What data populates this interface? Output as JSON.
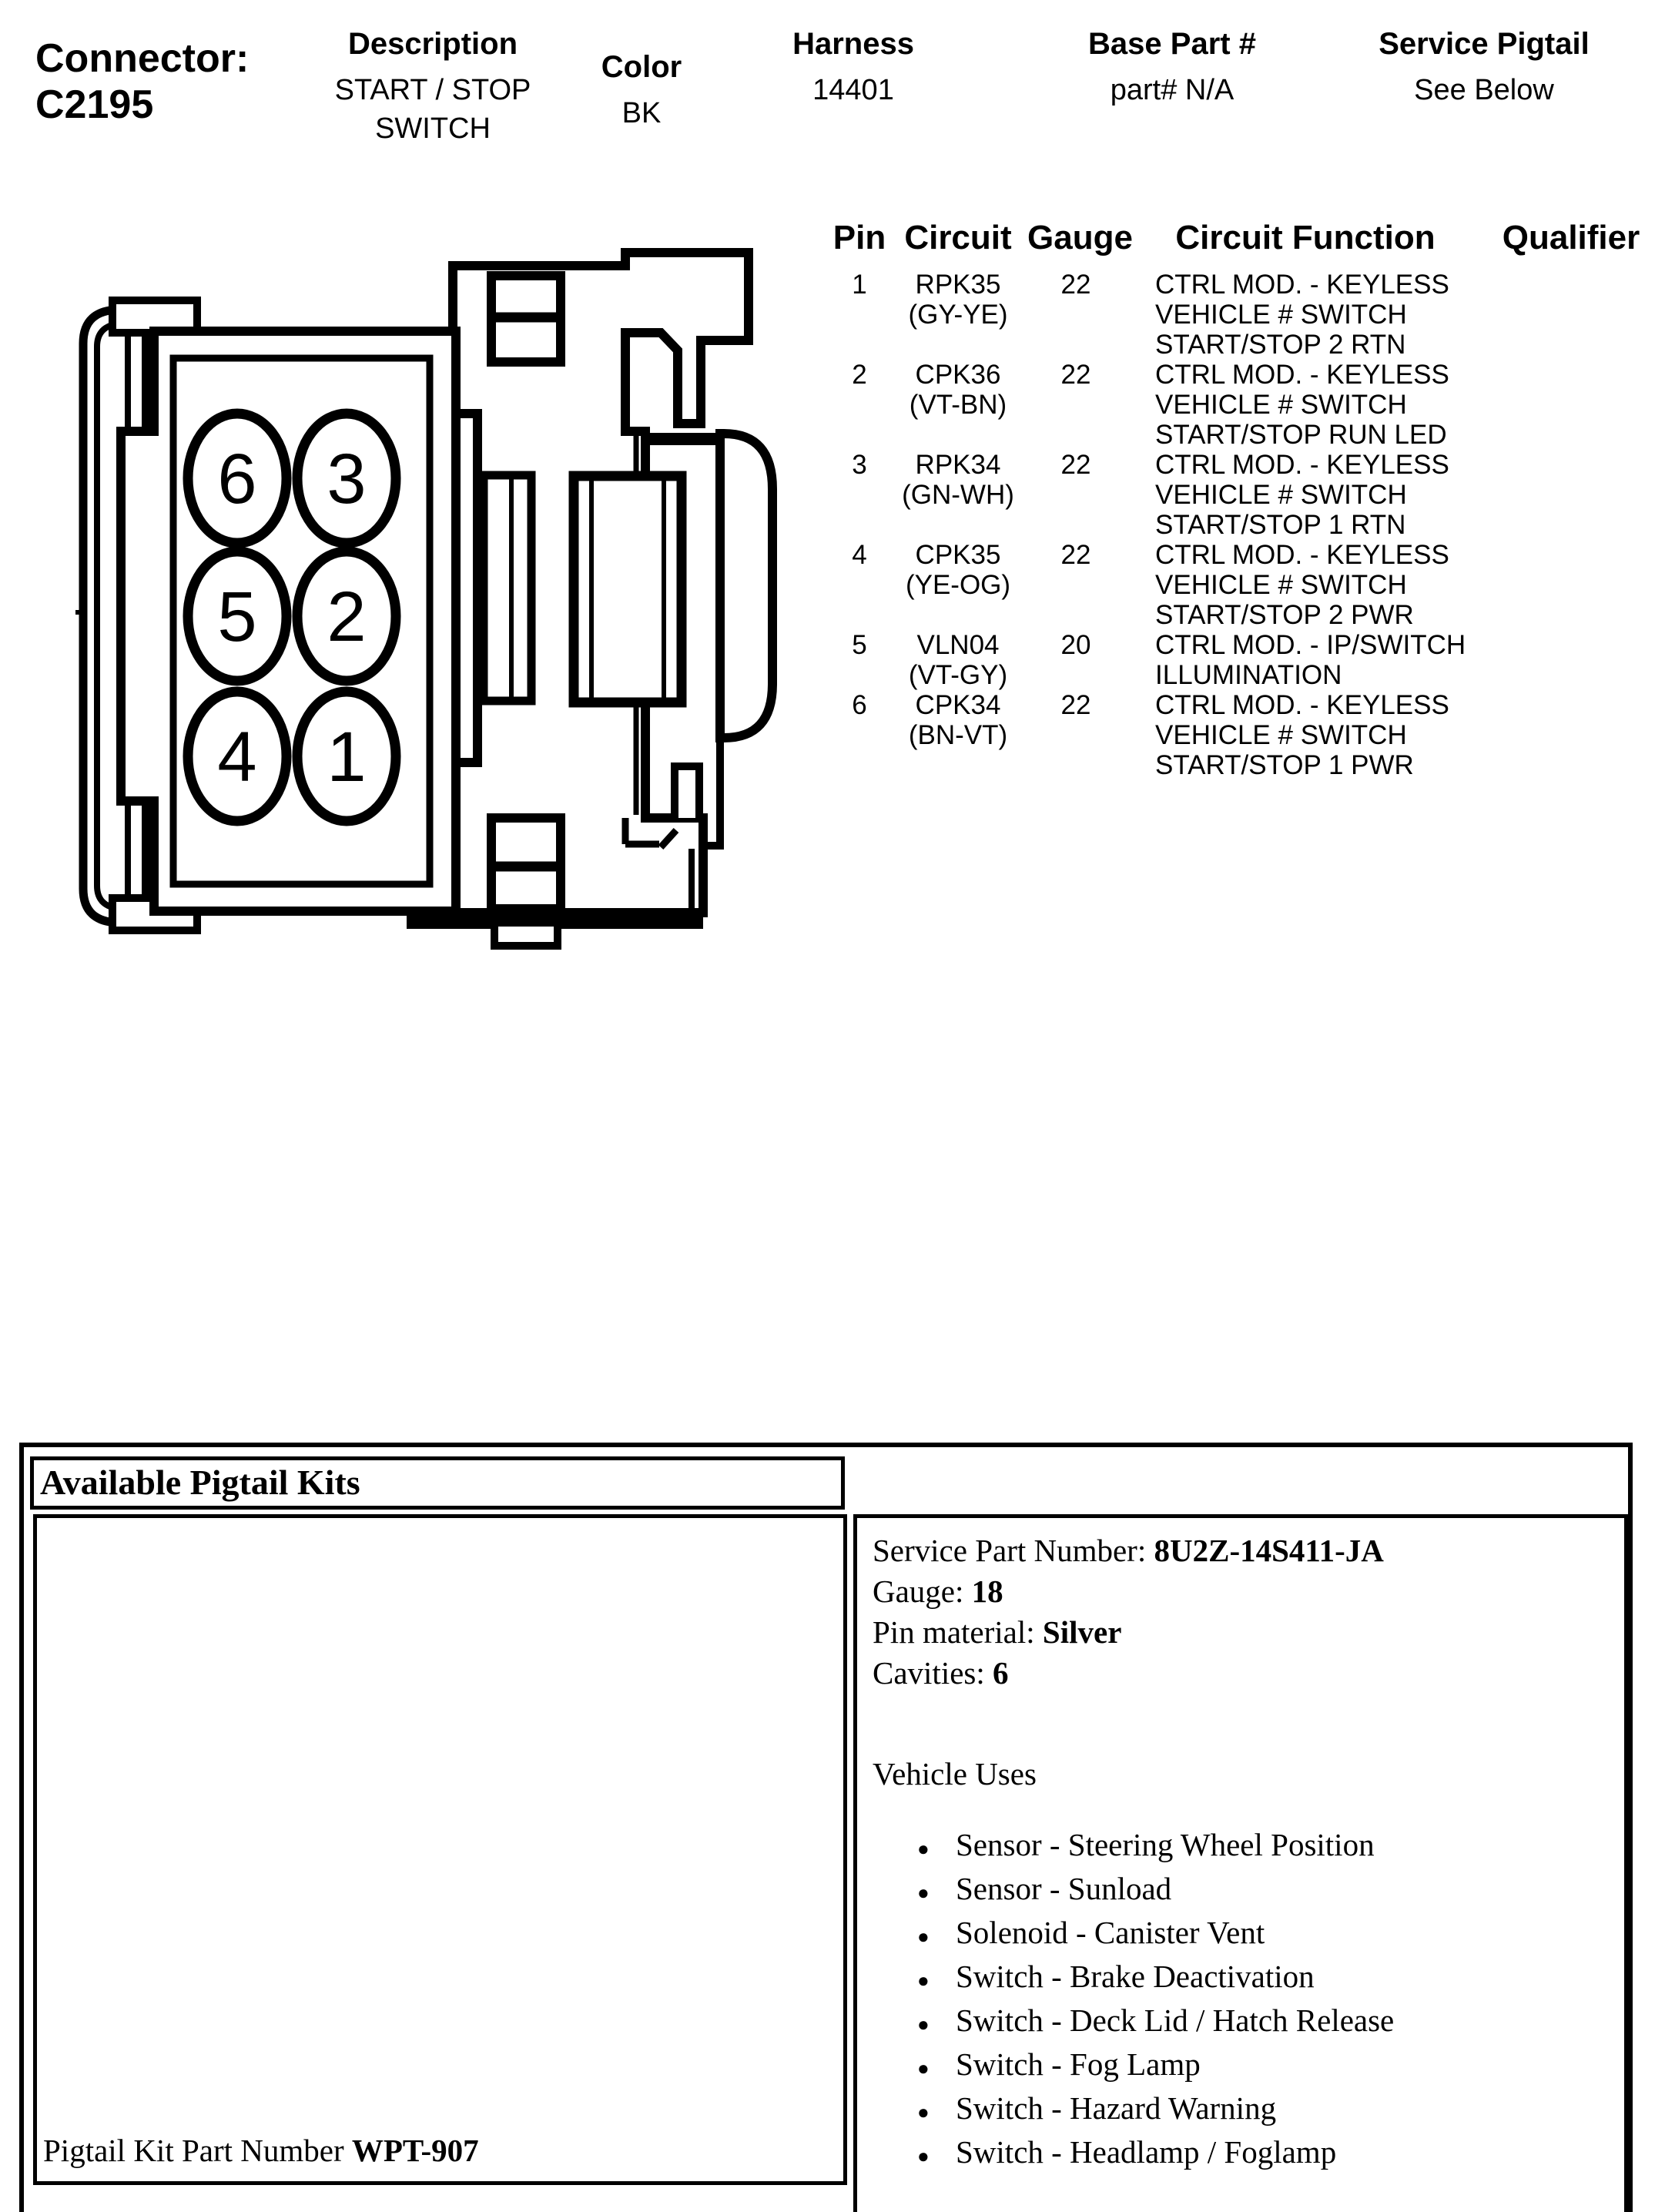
{
  "header": {
    "connector_label": "Connector:",
    "connector_id": "C2195",
    "description": {
      "label": "Description",
      "value": "START / STOP\nSWITCH"
    },
    "color": {
      "label": "Color",
      "value": "BK"
    },
    "harness": {
      "label": "Harness",
      "value": "14401"
    },
    "base_part": {
      "label": "Base Part #",
      "value": "part# N/A"
    },
    "service_pigtail": {
      "label": "Service Pigtail",
      "value": "See Below"
    }
  },
  "pin_table": {
    "headers": {
      "pin": "Pin",
      "circuit": "Circuit",
      "gauge": "Gauge",
      "function": "Circuit Function",
      "qualifier": "Qualifier"
    },
    "rows": [
      {
        "pin": "1",
        "circuit": "RPK35\n(GY-YE)",
        "gauge": "22",
        "function": "CTRL MOD. - KEYLESS\nVEHICLE # SWITCH\nSTART/STOP 2 RTN",
        "qualifier": ""
      },
      {
        "pin": "2",
        "circuit": "CPK36\n(VT-BN)",
        "gauge": "22",
        "function": "CTRL MOD. - KEYLESS\nVEHICLE # SWITCH\nSTART/STOP RUN LED",
        "qualifier": ""
      },
      {
        "pin": "3",
        "circuit": "RPK34\n(GN-WH)",
        "gauge": "22",
        "function": "CTRL MOD. - KEYLESS\nVEHICLE # SWITCH\nSTART/STOP 1 RTN",
        "qualifier": ""
      },
      {
        "pin": "4",
        "circuit": "CPK35\n(YE-OG)",
        "gauge": "22",
        "function": "CTRL MOD. - KEYLESS\nVEHICLE # SWITCH\nSTART/STOP 2 PWR",
        "qualifier": ""
      },
      {
        "pin": "5",
        "circuit": "VLN04\n(VT-GY)",
        "gauge": "20",
        "function": "CTRL MOD. - IP/SWITCH\nILLUMINATION",
        "qualifier": ""
      },
      {
        "pin": "6",
        "circuit": "CPK34\n(BN-VT)",
        "gauge": "22",
        "function": "CTRL MOD. - KEYLESS\nVEHICLE # SWITCH\nSTART/STOP 1 PWR",
        "qualifier": ""
      }
    ]
  },
  "diagram": {
    "pins": [
      "6",
      "3",
      "5",
      "2",
      "4",
      "1"
    ]
  },
  "pigtail": {
    "title": "Available Pigtail Kits",
    "kit_label": "Pigtail Kit Part Number ",
    "kit_number": "WPT-907",
    "service_part_label": "Service Part Number: ",
    "service_part_number": "8U2Z-14S411-JA",
    "gauge_label": "Gauge: ",
    "gauge_value": "18",
    "pin_material_label": "Pin material: ",
    "pin_material_value": "Silver",
    "cavities_label": "Cavities: ",
    "cavities_value": "6",
    "vehicle_uses_label": "Vehicle Uses",
    "bullet": "●",
    "vehicle_uses": [
      "Sensor - Steering Wheel Position",
      "Sensor - Sunload",
      "Solenoid - Canister Vent",
      "Switch - Brake Deactivation",
      "Switch - Deck Lid / Hatch Release",
      "Switch - Fog Lamp",
      "Switch - Hazard Warning",
      "Switch - Headlamp / Foglamp"
    ]
  }
}
